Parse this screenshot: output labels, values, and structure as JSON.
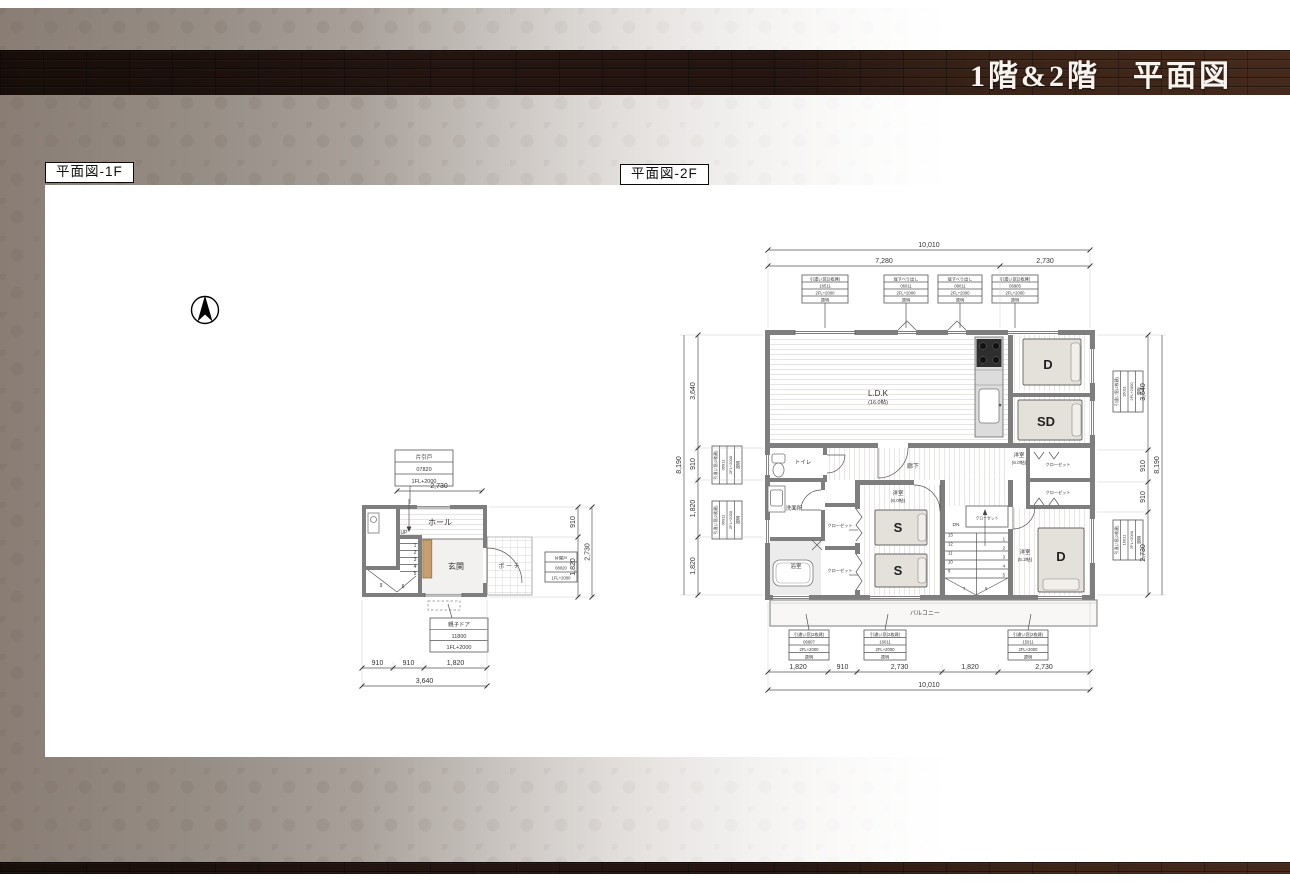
{
  "page": {
    "title": "1階&2階　平面図",
    "label_1f": "平面図-1F",
    "label_2f": "平面図-2F"
  },
  "f1": {
    "rooms": {
      "hall": "ホール",
      "genkan": "玄関",
      "porch": "ポ ー チ"
    },
    "stair": {
      "up": "UP",
      "steps": [
        "1",
        "2",
        "3",
        "4",
        "5"
      ],
      "winders": [
        "9",
        "6"
      ]
    },
    "specs": {
      "top": [
        "片引戸",
        "07820",
        "1FL+2000"
      ],
      "door": [
        "親子ドア",
        "11800",
        "1FL+2000"
      ],
      "side": [
        "片開戸",
        "08020",
        "1FL+2000"
      ]
    },
    "dims": {
      "top": "2,730",
      "right": [
        "910",
        "1,820"
      ],
      "right_total": "2,730",
      "bottom": [
        "910",
        "910",
        "1,820"
      ],
      "bottom_total": "3,640"
    }
  },
  "f2": {
    "rooms": {
      "ldk": "L.D.K",
      "ldk_size": "(16.0帖)",
      "corridor": "廊下",
      "toilet": "トイレ",
      "wash": "洗面所",
      "bath": "浴室",
      "bed_s": "洋室",
      "bed_s_size": "(6.0帖)",
      "bed_d2": "洋室",
      "bed_d2_size": "(6.0帖)",
      "bed_d": "洋室",
      "bed_d_size": "(5.2帖)",
      "closet": "クローゼット",
      "balcony": "バルコニー",
      "beds": {
        "d": "D",
        "sd": "SD",
        "s1": "S",
        "s2": "S"
      }
    },
    "stair": {
      "dn": "DN",
      "left": [
        "13",
        "12",
        "11",
        "10",
        "9"
      ],
      "right": [
        "1",
        "2",
        "3",
        "4",
        "5"
      ],
      "bottom": [
        "7",
        "6"
      ]
    },
    "specs": {
      "top": [
        [
          "引違い窓(2枚建)",
          "16511",
          "2FL+2000",
          "透明"
        ],
        [
          "縦すべり出し",
          "06011",
          "2FL+2000",
          "透明"
        ],
        [
          "縦すべり出し",
          "06011",
          "2FL+2000",
          "透明"
        ],
        [
          "引違い窓(2枚建)",
          "06905",
          "2FL+2000",
          "透明"
        ]
      ],
      "bottom": [
        [
          "引違い窓(2枚建)",
          "06907",
          "2FL+2000",
          "透明"
        ],
        [
          "引違い窓(2枚建)",
          "16011",
          "2FL+2000",
          "透明"
        ],
        [
          "引違い窓(2枚建)",
          "15011",
          "2FL+2000",
          "透明"
        ]
      ],
      "left": [
        [
          "引違い窓(2枚建)",
          "06911",
          "2FL+2000",
          "透明"
        ],
        [
          "引違い窓(2枚建)",
          "06911",
          "2FL+2000",
          "透明"
        ]
      ],
      "right": [
        [
          "引違い窓(2枚建)",
          "16011",
          "2FL+2000",
          "透明"
        ],
        [
          "引違い窓(2枚建)",
          "16011",
          "2FL+2000",
          "透明"
        ]
      ]
    },
    "dims": {
      "top_total": "10,010",
      "top": [
        "7,280",
        "2,730"
      ],
      "bottom": [
        "1,820",
        "910",
        "2,730",
        "1,820",
        "2,730"
      ],
      "bottom_total": "10,010",
      "left": [
        "3,640",
        "910",
        "1,820",
        "1,820"
      ],
      "left_total": "8,190",
      "right": [
        "3,640",
        "910",
        "910",
        "2,730"
      ],
      "right_total": "8,190"
    }
  }
}
